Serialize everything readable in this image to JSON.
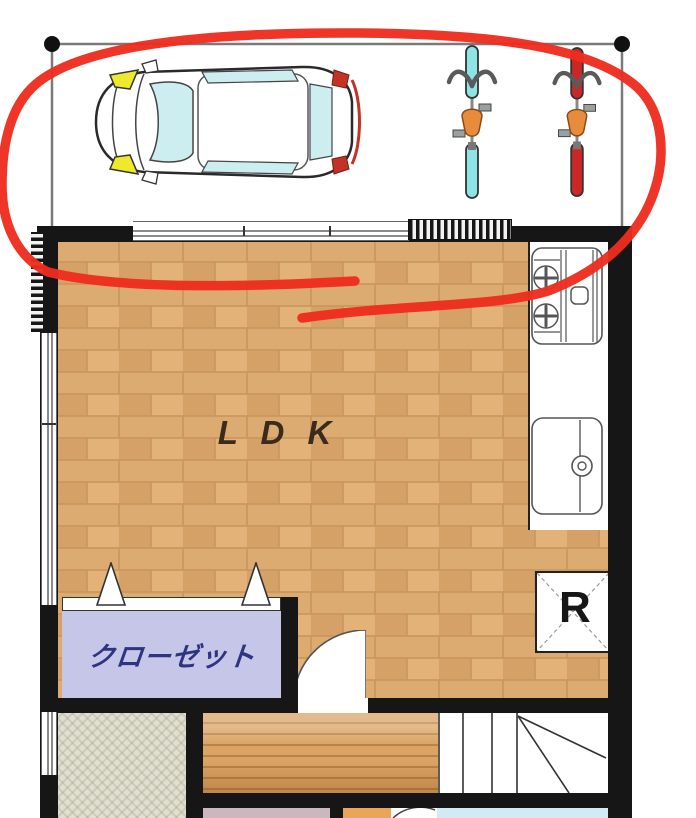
{
  "floor_plan": {
    "labels": {
      "ldk": "L D K",
      "closet": "クローゼット",
      "refrigerator": "R"
    },
    "annotation": {
      "shape": "hand-drawn red loop circling the parking area",
      "color": "#ee2d1e"
    },
    "objects": {
      "car": "car-top-view",
      "bicycle_1": "bicycle-cyan",
      "bicycle_2": "bicycle-red",
      "kitchen": [
        "stove",
        "sink"
      ],
      "refrigerator": "refrigerator-box",
      "stairs": "winder-staircase",
      "doors": [
        "folding-closet-door",
        "swing-door"
      ]
    },
    "colors": {
      "wall": "#161616",
      "ldk_floor": "#dcab72",
      "closet_fill": "#c6c6e8",
      "closet_text": "#2e3480",
      "tatami_floor": "#e0dfd0",
      "hallway_wood": "#dba364",
      "room_mauve": "#cbb7be",
      "room_blue": "#d2eaf3",
      "room_orange": "#eba559",
      "bike_cyan": "#8de4e4",
      "bike_red": "#cc2727",
      "saddle": "#e78c3c",
      "headlight": "#eee92c",
      "glass": "#cdeef0",
      "annotation": "#ee2d1e"
    }
  }
}
